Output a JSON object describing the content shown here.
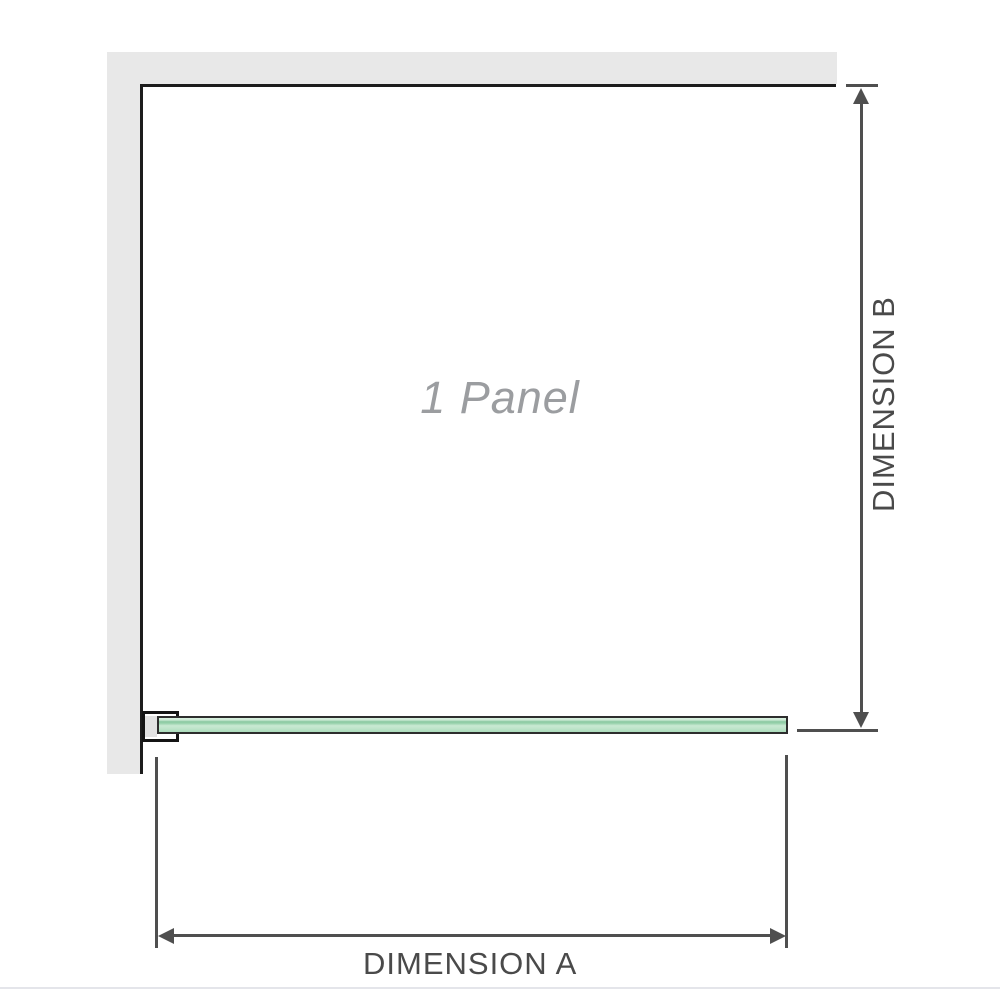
{
  "diagram": {
    "panel_label": "1 Panel",
    "dimension_a_label": "DIMENSION A",
    "dimension_b_label": "DIMENSION B"
  },
  "colors": {
    "wall_fill": "#e8e8e8",
    "enclosure_outline": "#1c1c1c",
    "bracket_outline": "#141414",
    "glass_light_green": "#cdead6",
    "glass_mid_green": "#8cc9a2",
    "dimension_line": "#4f4f4f",
    "dimension_text": "#4a4a4a",
    "panel_label_text": "#9b9da0"
  }
}
